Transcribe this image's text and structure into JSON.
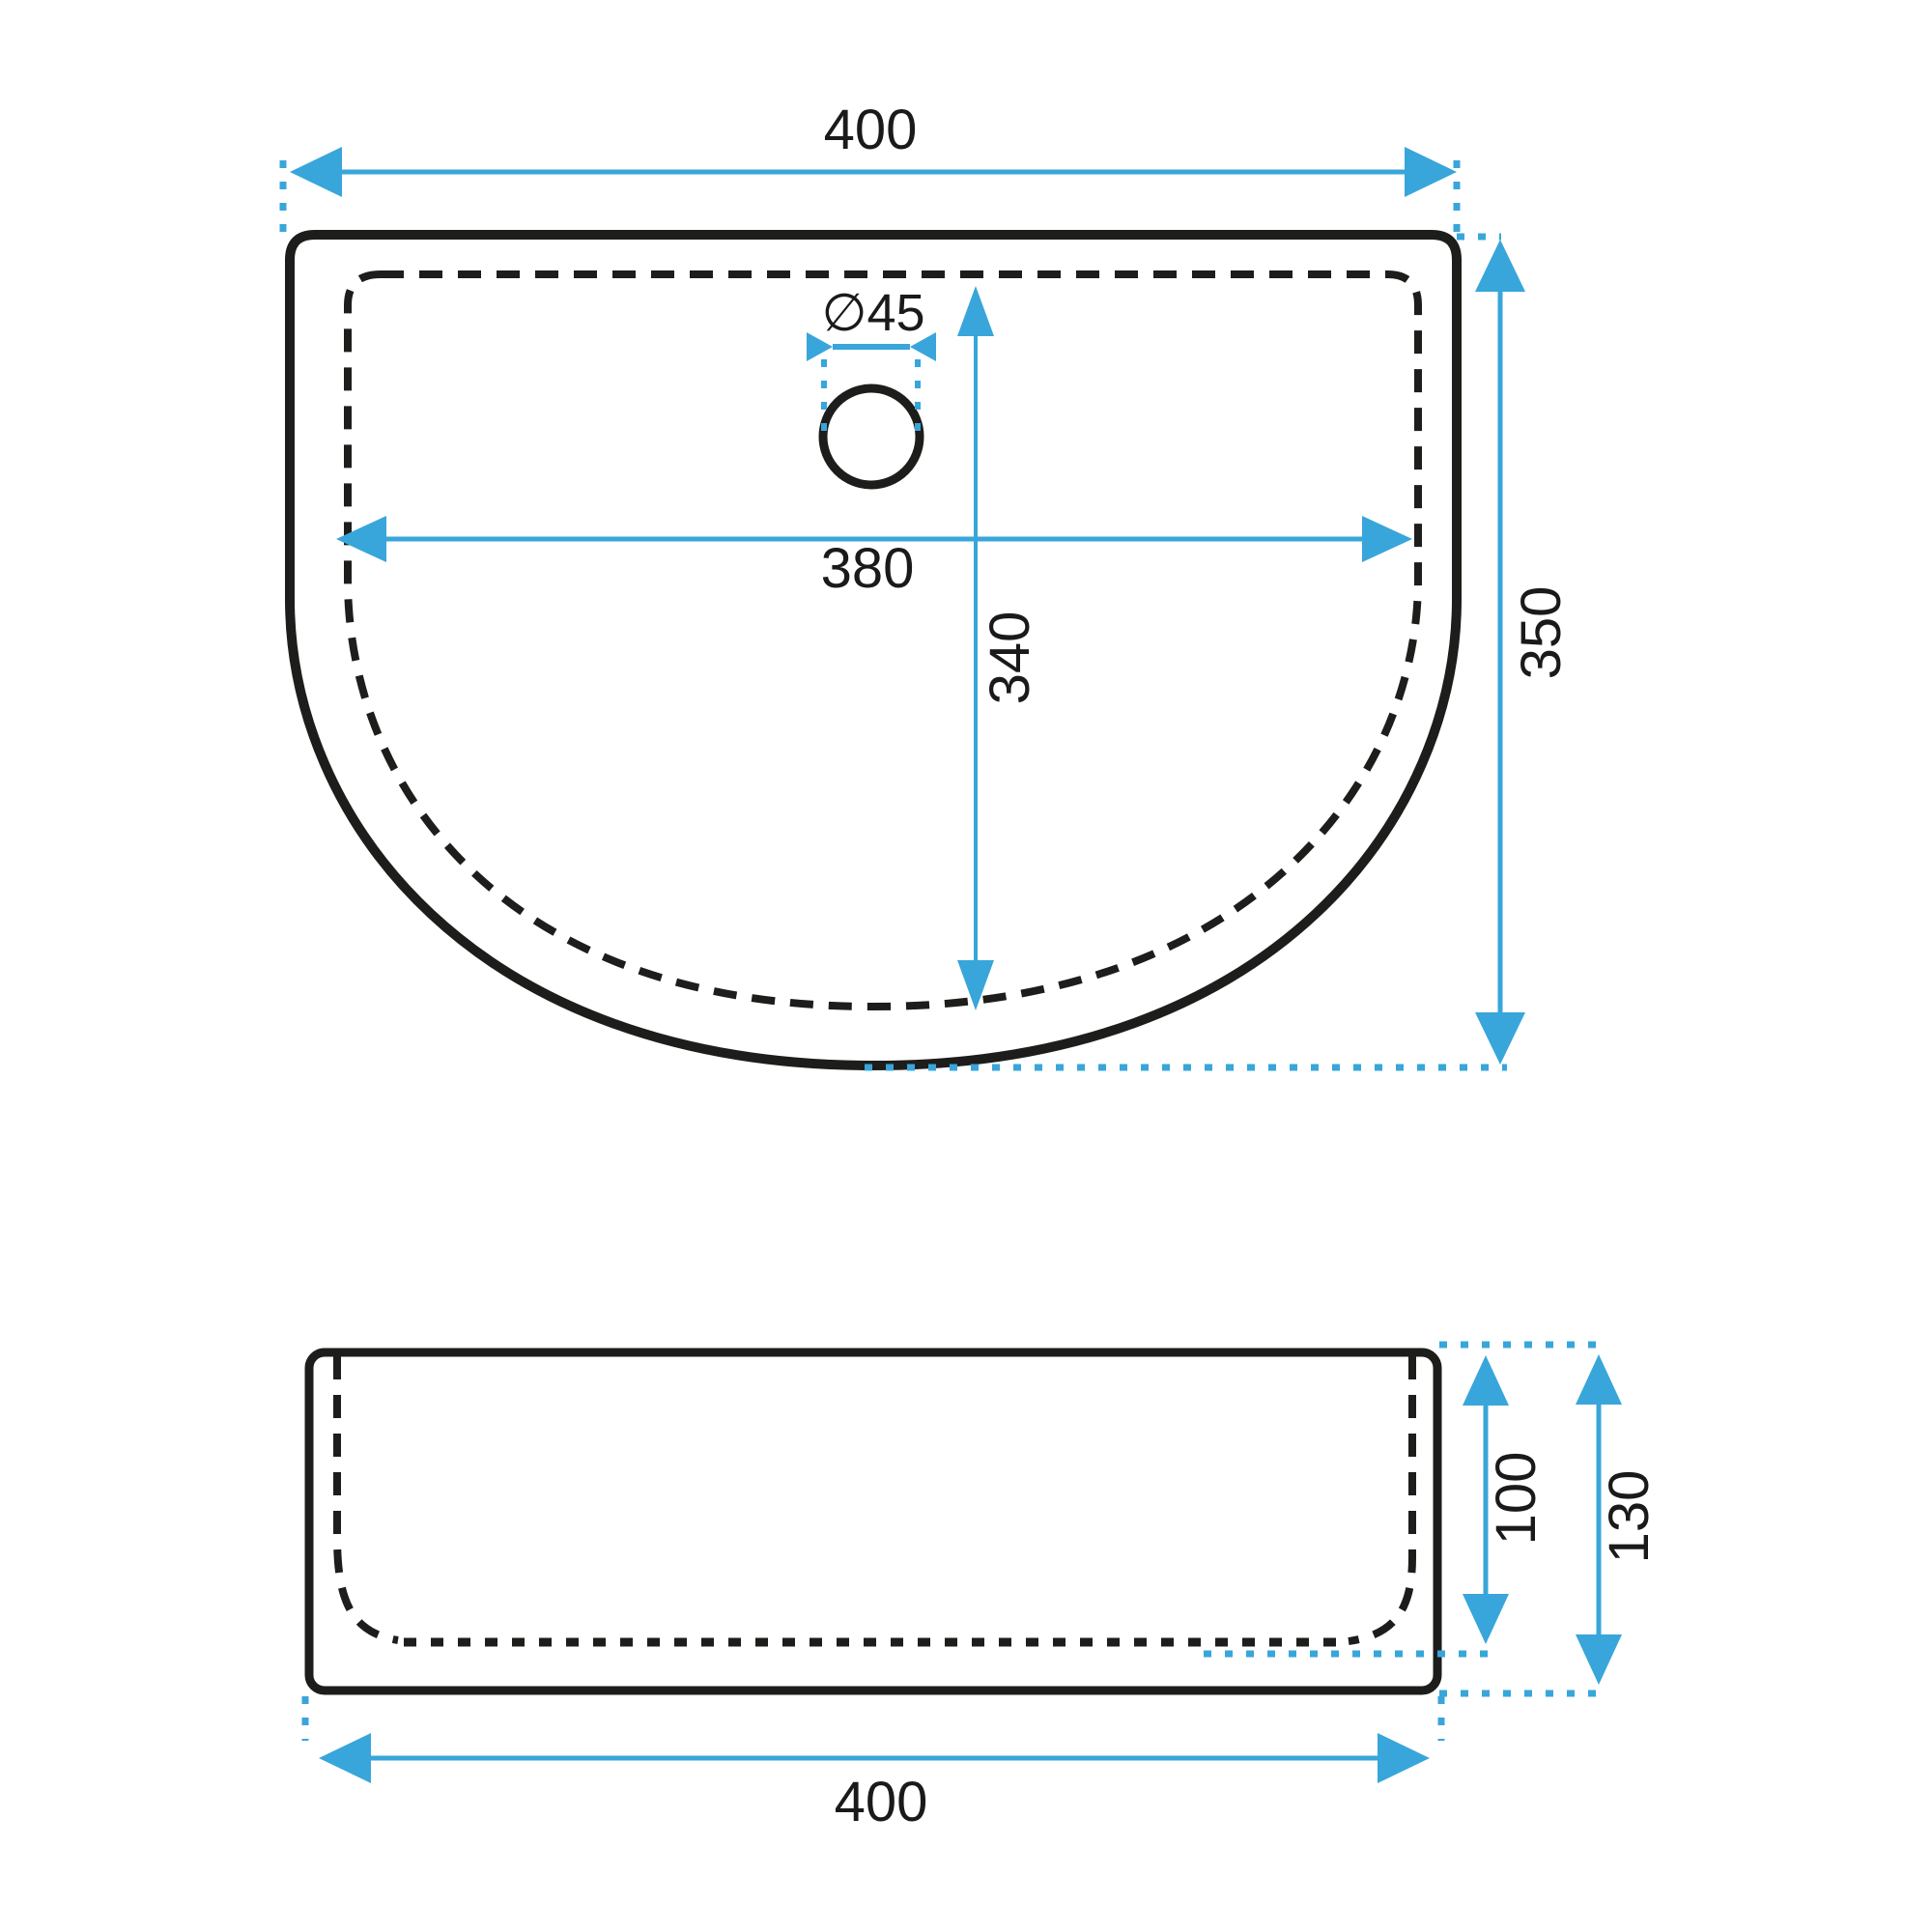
{
  "drawing": {
    "type": "washbasin-technical-dimension-drawing",
    "colors": {
      "dimension_blue": "#38a6da",
      "line_black": "#1d1d1b",
      "text_black": "#1a1a1a",
      "background": "#ffffff"
    },
    "top_view": {
      "overall_width": "400",
      "drain_diameter": "∅45",
      "inner_width": "380",
      "inner_depth": "340",
      "overall_depth": "350"
    },
    "front_view": {
      "overall_width": "400",
      "basin_depth": "100",
      "overall_height": "130"
    }
  }
}
